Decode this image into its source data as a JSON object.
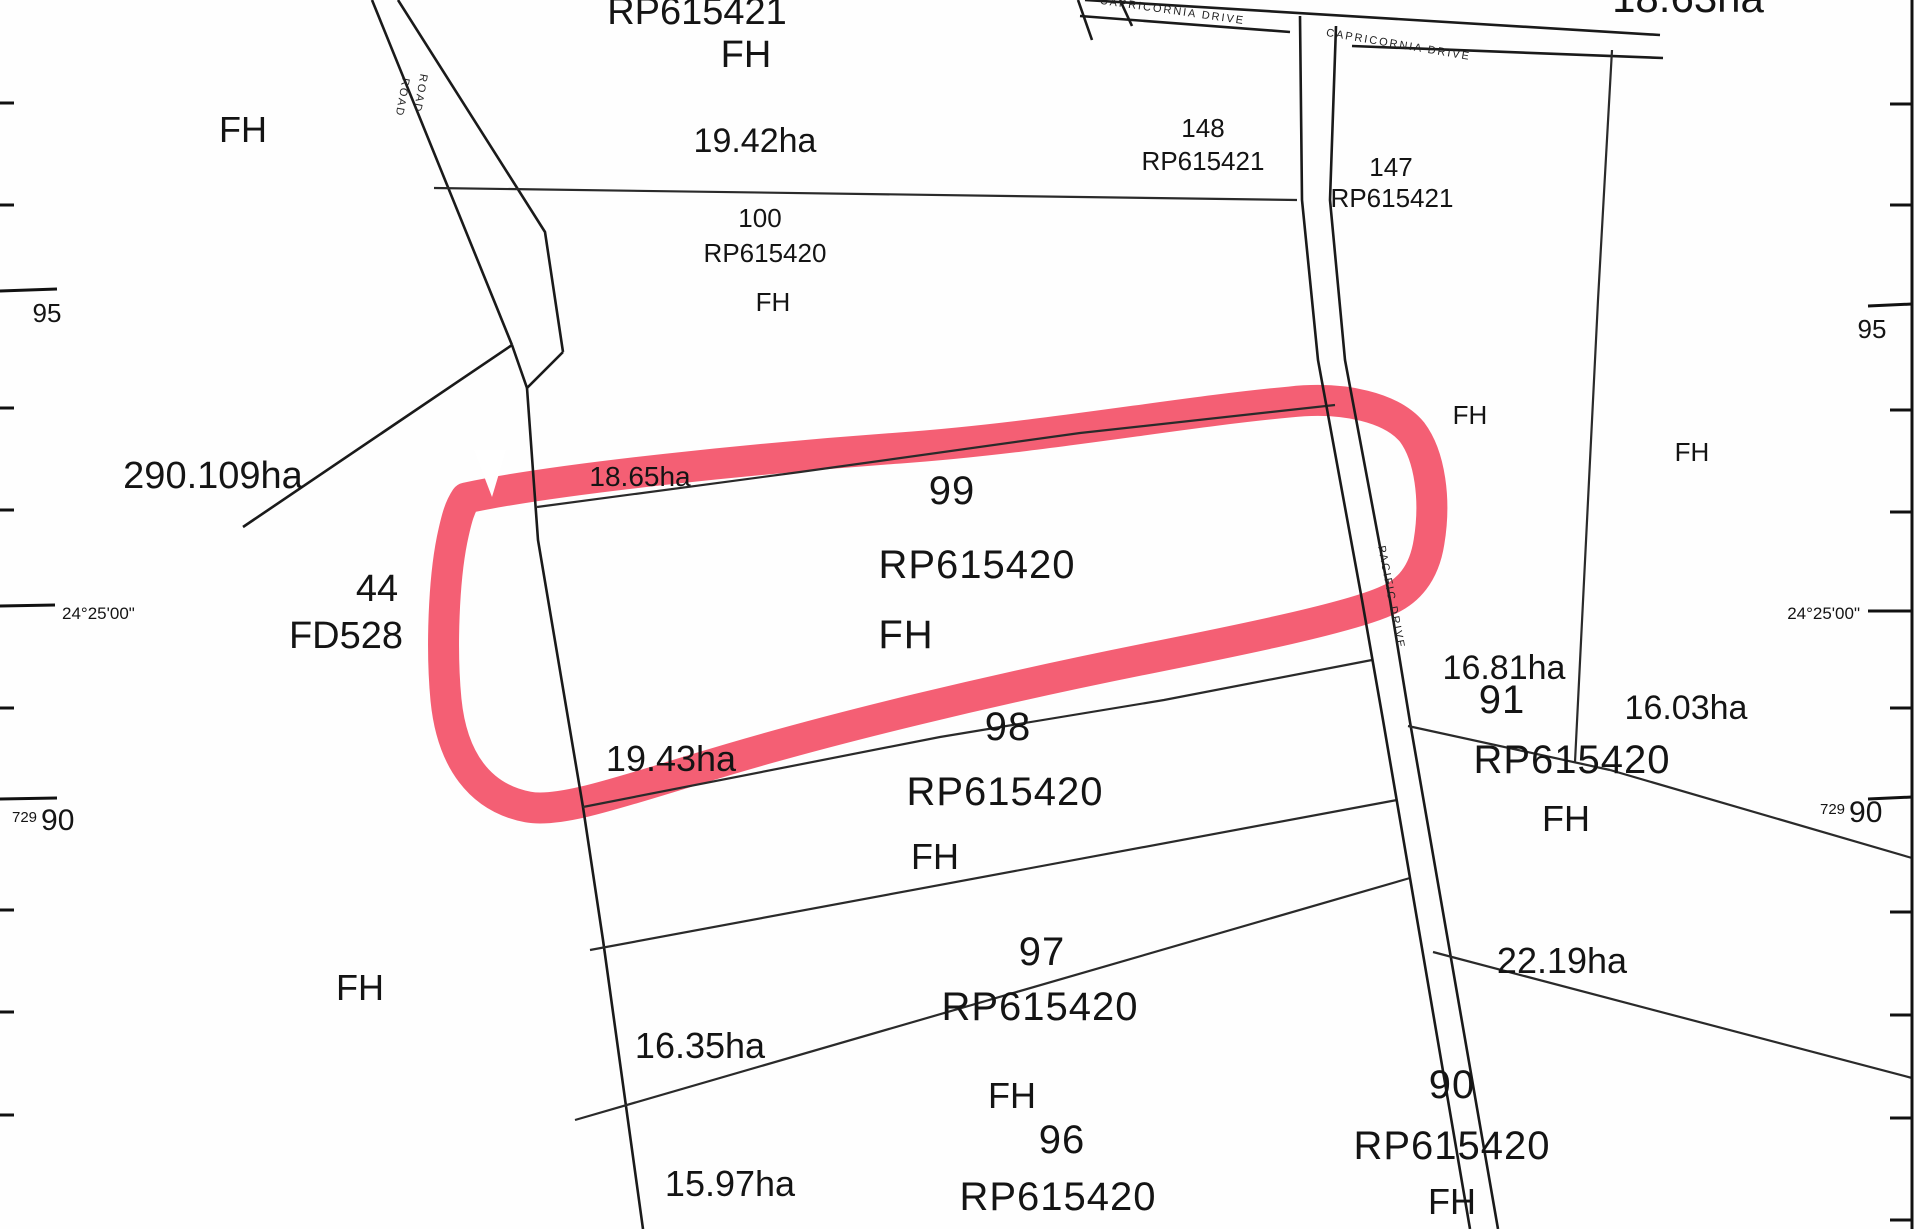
{
  "title": "Cadastral survey plan with highlighted lot",
  "colors": {
    "background": "#ffffff",
    "boundary_line": "#1a1a1a",
    "highlight": "#f3566d",
    "text": "#141414"
  },
  "annotation": {
    "type": "hand-drawn marker loop",
    "highlighted_lot": "99",
    "color": "#f3566d"
  },
  "parcels": {
    "north_strip": {
      "plan": "RP615421",
      "tenure": "FH",
      "area": "19.42ha"
    },
    "northwest": {
      "tenure": "FH"
    },
    "lot100": {
      "lot": "100",
      "plan": "RP615420",
      "tenure": "FH"
    },
    "lot148": {
      "lot": "148",
      "plan": "RP615421",
      "tenure": "FH",
      "area": "16.81ha"
    },
    "lot147": {
      "lot": "147",
      "plan": "RP615421",
      "tenure": "FH",
      "area": "16.03ha"
    },
    "lot99": {
      "lot": "99",
      "plan": "RP615420",
      "tenure": "FH",
      "area": "18.65ha"
    },
    "lot98": {
      "lot": "98",
      "plan": "RP615420",
      "tenure": "FH",
      "area": "19.43ha"
    },
    "lot97": {
      "lot": "97",
      "plan": "RP615420",
      "tenure": "FH",
      "area": "16.35ha"
    },
    "lot96": {
      "lot": "96",
      "plan": "RP615420",
      "area": "15.97ha"
    },
    "lot91": {
      "lot": "91",
      "plan": "RP615420",
      "tenure": "FH"
    },
    "lot90": {
      "lot": "90",
      "plan": "RP615420",
      "tenure": "FH",
      "area": "22.19ha"
    },
    "lot44": {
      "lot": "44",
      "plan": "FD528",
      "tenure": "FH",
      "area": "290.109ha"
    },
    "top_right_clipped_area": "18.63ha"
  },
  "roads": {
    "road": "ROAD",
    "capricornia": "CAPRICORNIA  DRIVE",
    "pacific": "PACIFIC  DRIVE"
  },
  "grid": {
    "northing_95": "95",
    "latitude": "24°25'00\"",
    "northing_prefix": "729",
    "northing_90": "90"
  }
}
